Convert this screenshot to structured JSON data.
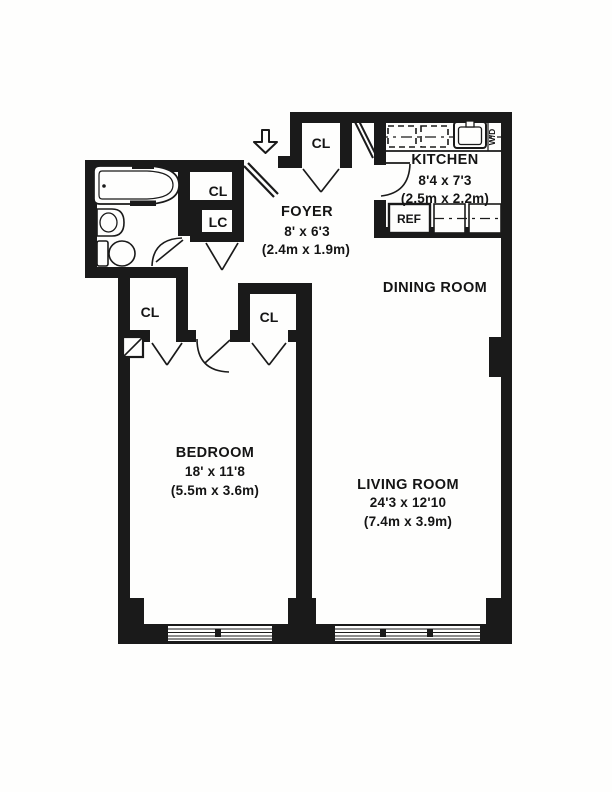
{
  "document": {
    "type": "apartment-floor-plan"
  },
  "colors": {
    "ink": "#1a1a1a",
    "paper": "#fefefd"
  },
  "rooms": {
    "foyer": {
      "name": "FOYER",
      "size_imperial": "8' x 6'3",
      "size_metric": "(2.4m x 1.9m)"
    },
    "kitchen": {
      "name": "KITCHEN",
      "size_imperial": "8'4 x 7'3",
      "size_metric": "(2.5m x 2.2m)"
    },
    "dining_room": {
      "name": "DINING ROOM"
    },
    "bedroom": {
      "name": "BEDROOM",
      "size_imperial": "18' x 11'8",
      "size_metric": "(5.5m x 3.6m)"
    },
    "living_room": {
      "name": "LIVING ROOM",
      "size_imperial": "24'3 x 12'10",
      "size_metric": "(7.4m x 3.9m)"
    }
  },
  "closets": {
    "entry_closet": "CL",
    "hall_closet": "CL",
    "linen_closet": "LC",
    "bedroom_closet_left": "CL",
    "bedroom_closet_right": "CL"
  },
  "appliances": {
    "refrigerator": "REF",
    "washer_dryer": "W/D"
  }
}
